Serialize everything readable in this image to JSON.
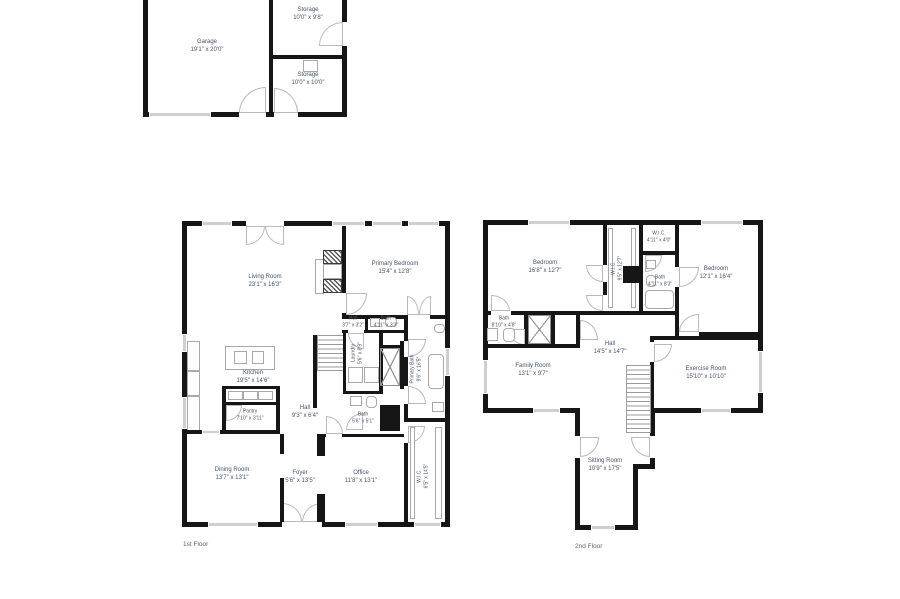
{
  "colors": {
    "wall": "#161616",
    "text": "#47546a",
    "window": "#cfcfcf",
    "door_arc": "#b9b9b9",
    "background": "#ffffff"
  },
  "garage_level": {
    "rooms": {
      "garage": {
        "name": "Garage",
        "dims": "19'1\" x 20'0\""
      },
      "storage_upper": {
        "name": "Storage",
        "dims": "10'0\" x 9'8\""
      },
      "storage_lower": {
        "name": "Storage",
        "dims": "10'0\" x 10'0\""
      }
    }
  },
  "first_floor": {
    "label": "1st Floor",
    "rooms": {
      "living_room": {
        "name": "Living Room",
        "dims": "23'1\" x 16'3\""
      },
      "primary_bedroom": {
        "name": "Primary Bedroom",
        "dims": "15'4\" x 12'8\""
      },
      "hall_upper": {
        "name": "Hall",
        "dims": "3'7\" x 3'2\""
      },
      "bath_upper": {
        "name": "Bath",
        "dims": "4'11\" x 3'3\""
      },
      "kitchen": {
        "name": "Kitchen",
        "dims": "19'5\" x 14'6\""
      },
      "laundry": {
        "name": "Laundry",
        "dims": "5'6\" x 8'9\""
      },
      "primary_bath": {
        "name": "Primary Bath",
        "dims": "9'6\" x 16'5\""
      },
      "pantry": {
        "name": "Pantry",
        "dims": "7'10\" x 3'11\""
      },
      "hall_main": {
        "name": "Hall",
        "dims": "9'3\" x 6'4\""
      },
      "bath_lower": {
        "name": "Bath",
        "dims": "5'6\" x 5'1\""
      },
      "dining_room": {
        "name": "Dining Room",
        "dims": "13'7\" x 13'1\""
      },
      "foyer": {
        "name": "Foyer",
        "dims": "5'6\" x 13'5\""
      },
      "office": {
        "name": "Office",
        "dims": "11'8\" x 13'1\""
      },
      "wic": {
        "name": "W.I.C.",
        "dims": "6'5\" x 14'5\""
      }
    }
  },
  "second_floor": {
    "label": "2nd Floor",
    "rooms": {
      "bedroom_left": {
        "name": "Bedroom",
        "dims": "16'8\" x 12'7\""
      },
      "wic_main": {
        "name": "W.I.C.",
        "dims": "9'5\" x 12'7\""
      },
      "wic_small": {
        "name": "W.I.C.",
        "dims": "4'11\" x 4'0\""
      },
      "bath_upper": {
        "name": "Bath",
        "dims": "4'11\" x 8'3\""
      },
      "bedroom_right": {
        "name": "Bedroom",
        "dims": "12'1\" x 16'4\""
      },
      "bath_left": {
        "name": "Bath",
        "dims": "8'10\" x 4'8\""
      },
      "hall": {
        "name": "Hall",
        "dims": "14'5\" x 14'7\""
      },
      "family_room": {
        "name": "Family Room",
        "dims": "13'1\" x 9'7\""
      },
      "exercise_room": {
        "name": "Exercise Room",
        "dims": "15'10\" x 10'10\""
      },
      "sitting_room": {
        "name": "Sitting Room",
        "dims": "10'9\" x 17'5\""
      }
    }
  }
}
